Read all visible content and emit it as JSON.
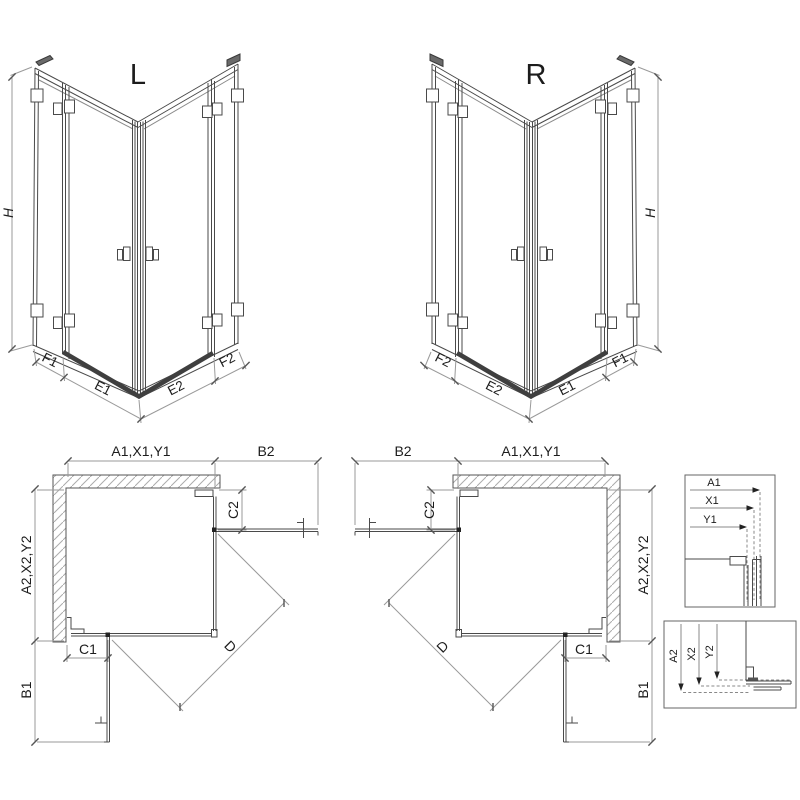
{
  "iso_l": {
    "view": "L",
    "h": "H",
    "f1": "F1",
    "e1": "E1",
    "e2": "E2",
    "f2": "F2"
  },
  "iso_r": {
    "view": "R",
    "h": "H",
    "f1": "F1",
    "e1": "E1",
    "e2": "E2",
    "f2": "F2"
  },
  "plan_l": {
    "a1": "A1,X1,Y1",
    "b2": "B2",
    "c2": "C2",
    "a2": "A2,X2,Y2",
    "c1": "C1",
    "b1": "B1",
    "d": "D"
  },
  "plan_r": {
    "a1": "A1,X1,Y1",
    "b2": "B2",
    "c2": "C2",
    "a2": "A2,X2,Y2",
    "c1": "C1",
    "b1": "B1",
    "d": "D"
  },
  "detail_top": {
    "a1": "A1",
    "x1": "X1",
    "y1": "Y1"
  },
  "detail_bottom": {
    "a2": "A2",
    "x2": "X2",
    "y2": "Y2"
  },
  "colors": {
    "line": "#4a4a4a",
    "dim": "#9a9a9a",
    "dark": "#222222",
    "tray": "#3f3f3f",
    "hatch": "#aaaaaa",
    "background": "#ffffff"
  }
}
